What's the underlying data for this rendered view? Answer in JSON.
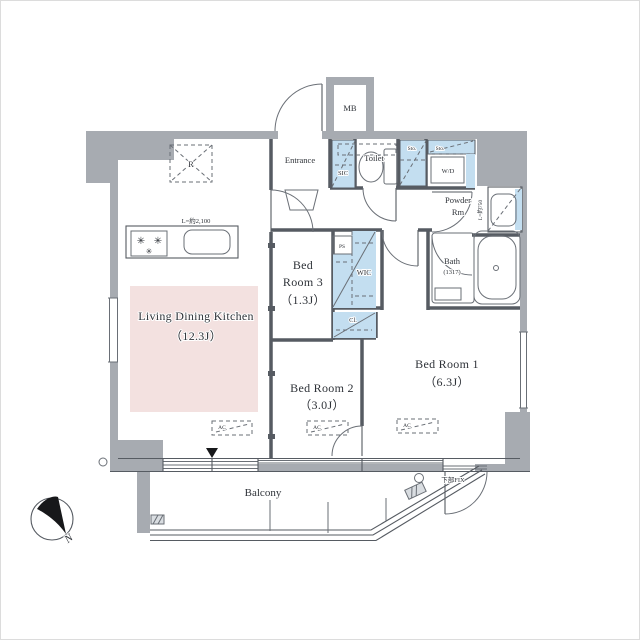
{
  "title": "apartment-floor-plan",
  "colors": {
    "wall_fill": "#a7abb1",
    "closet_fill": "#c3def0",
    "ldk_highlight": "#f3e1e0",
    "line": "#565b62",
    "text": "#2e3238"
  },
  "rooms": {
    "ldk": {
      "name": "Living Dining Kitchen",
      "size": "（12.3J）"
    },
    "bedroom1": {
      "name": "Bed Room 1",
      "size": "（6.3J）"
    },
    "bedroom2": {
      "name": "Bed Room 2",
      "size": "（3.0J）"
    },
    "bedroom3": {
      "line1": "Bed",
      "line2": "Room 3",
      "size": "（1.3J）"
    },
    "entrance": {
      "name": "Entrance"
    },
    "toilet": {
      "name": "Toilet"
    },
    "powder": {
      "line1": "Powder",
      "line2": "Rm"
    },
    "bath": {
      "name": "Bath",
      "size": "(1317)"
    },
    "balcony": {
      "name": "Balcony"
    }
  },
  "fixtures": {
    "meter_box": "MB",
    "shoe_closet": "SIC",
    "walk_in_closet": "WIC",
    "closet": "Cl.",
    "pipe_space": "PS",
    "refrigerator": "R",
    "washer_dryer": "W/D",
    "storage_a": "Sto.",
    "storage_b": "Sto.",
    "air_con": "AC",
    "kitchen_counter_length": "L=約2,100",
    "vanity_length": "L=約750",
    "fixed_window": "下部FIX"
  },
  "compass": {
    "north": "N"
  }
}
